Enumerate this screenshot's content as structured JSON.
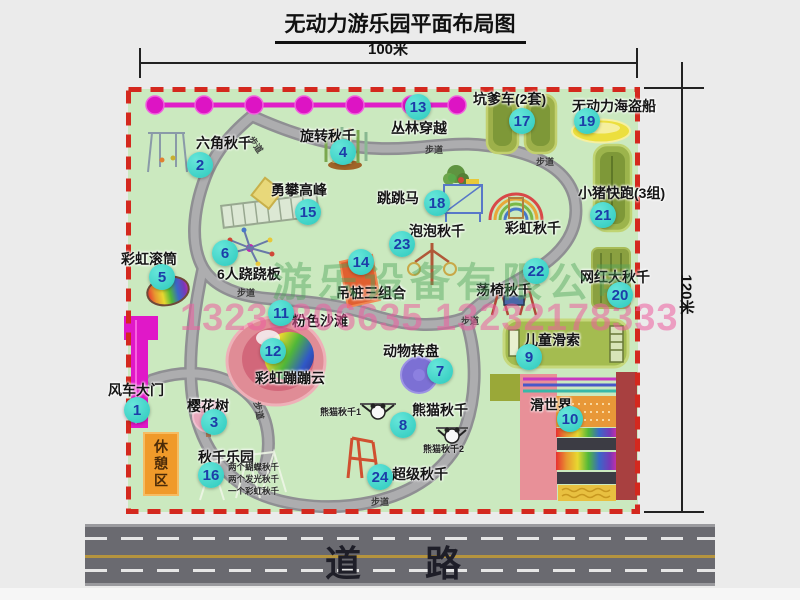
{
  "title": "无动力游乐园平面布局图",
  "scale": {
    "width": "100米",
    "height": "120米"
  },
  "road": {
    "label": "道　路"
  },
  "watermark": {
    "company": "游乐设备有限公司",
    "phone": "13233806635 13232178333"
  },
  "map": {
    "rest_area": "休憩区",
    "rainbow_swing": "彩虹秋千",
    "path_label": "步道",
    "panda_swing_1": "熊猫秋千1",
    "panda_swing_2": "熊猫秋千2",
    "swing_park_notes": [
      "两个蝴蝶秋千",
      "两个发光秋千",
      "一个彩虹秋千"
    ]
  },
  "attractions": [
    {
      "num": "1",
      "name": "风车大门"
    },
    {
      "num": "2",
      "name": "六角秋千"
    },
    {
      "num": "3",
      "name": "樱花树"
    },
    {
      "num": "4",
      "name": "旋转秋千"
    },
    {
      "num": "5",
      "name": "彩虹滚筒"
    },
    {
      "num": "6",
      "name": "6人跷跷板"
    },
    {
      "num": "7",
      "name": "动物转盘"
    },
    {
      "num": "8",
      "name": "熊猫秋千"
    },
    {
      "num": "9",
      "name": "儿童滑索"
    },
    {
      "num": "10",
      "name": "滑世界"
    },
    {
      "num": "11",
      "name": "粉色沙滩"
    },
    {
      "num": "12",
      "name": "彩虹蹦蹦云"
    },
    {
      "num": "13",
      "name": "丛林穿越"
    },
    {
      "num": "14",
      "name": "吊桩三组合"
    },
    {
      "num": "15",
      "name": "勇攀高峰"
    },
    {
      "num": "16",
      "name": "秋千乐园"
    },
    {
      "num": "17",
      "name": "坑爹车(2套)"
    },
    {
      "num": "18",
      "name": "跳跳马"
    },
    {
      "num": "19",
      "name": "无动力海盗船"
    },
    {
      "num": "20",
      "name": "网红大秋千"
    },
    {
      "num": "21",
      "name": "小猪快跑(3组)"
    },
    {
      "num": "22",
      "name": "荡椅秋千"
    },
    {
      "num": "23",
      "name": "泡泡秋千"
    },
    {
      "num": "24",
      "name": "超级秋千"
    }
  ],
  "colors": {
    "map_green": "#cbe9bf",
    "border_red": "#d4281e",
    "badge_teal": "#2fd0c4",
    "magenta": "#e018c8",
    "road_gray": "#6a6a70",
    "rest_orange": "#f09a2a"
  }
}
